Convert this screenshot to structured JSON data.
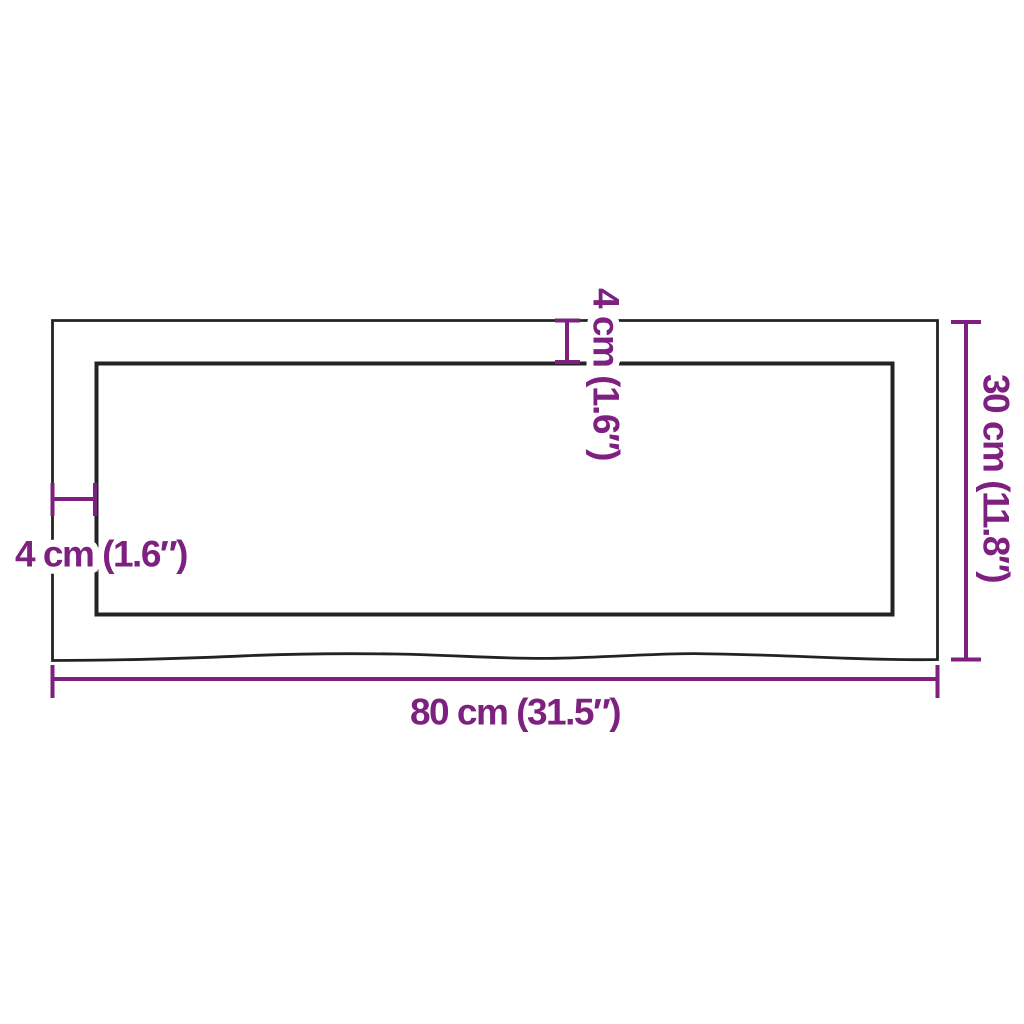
{
  "colors": {
    "dimension": "#7e2080",
    "outline": "#232323",
    "background": "#ffffff"
  },
  "dimensions": {
    "width": {
      "label": "80 cm (31.5″)"
    },
    "height": {
      "label": "30 cm (11.8″)"
    },
    "thickness_left": {
      "label": "4 cm (1.6″)"
    },
    "thickness_top": {
      "label": "4 cm (1.6″)"
    }
  }
}
